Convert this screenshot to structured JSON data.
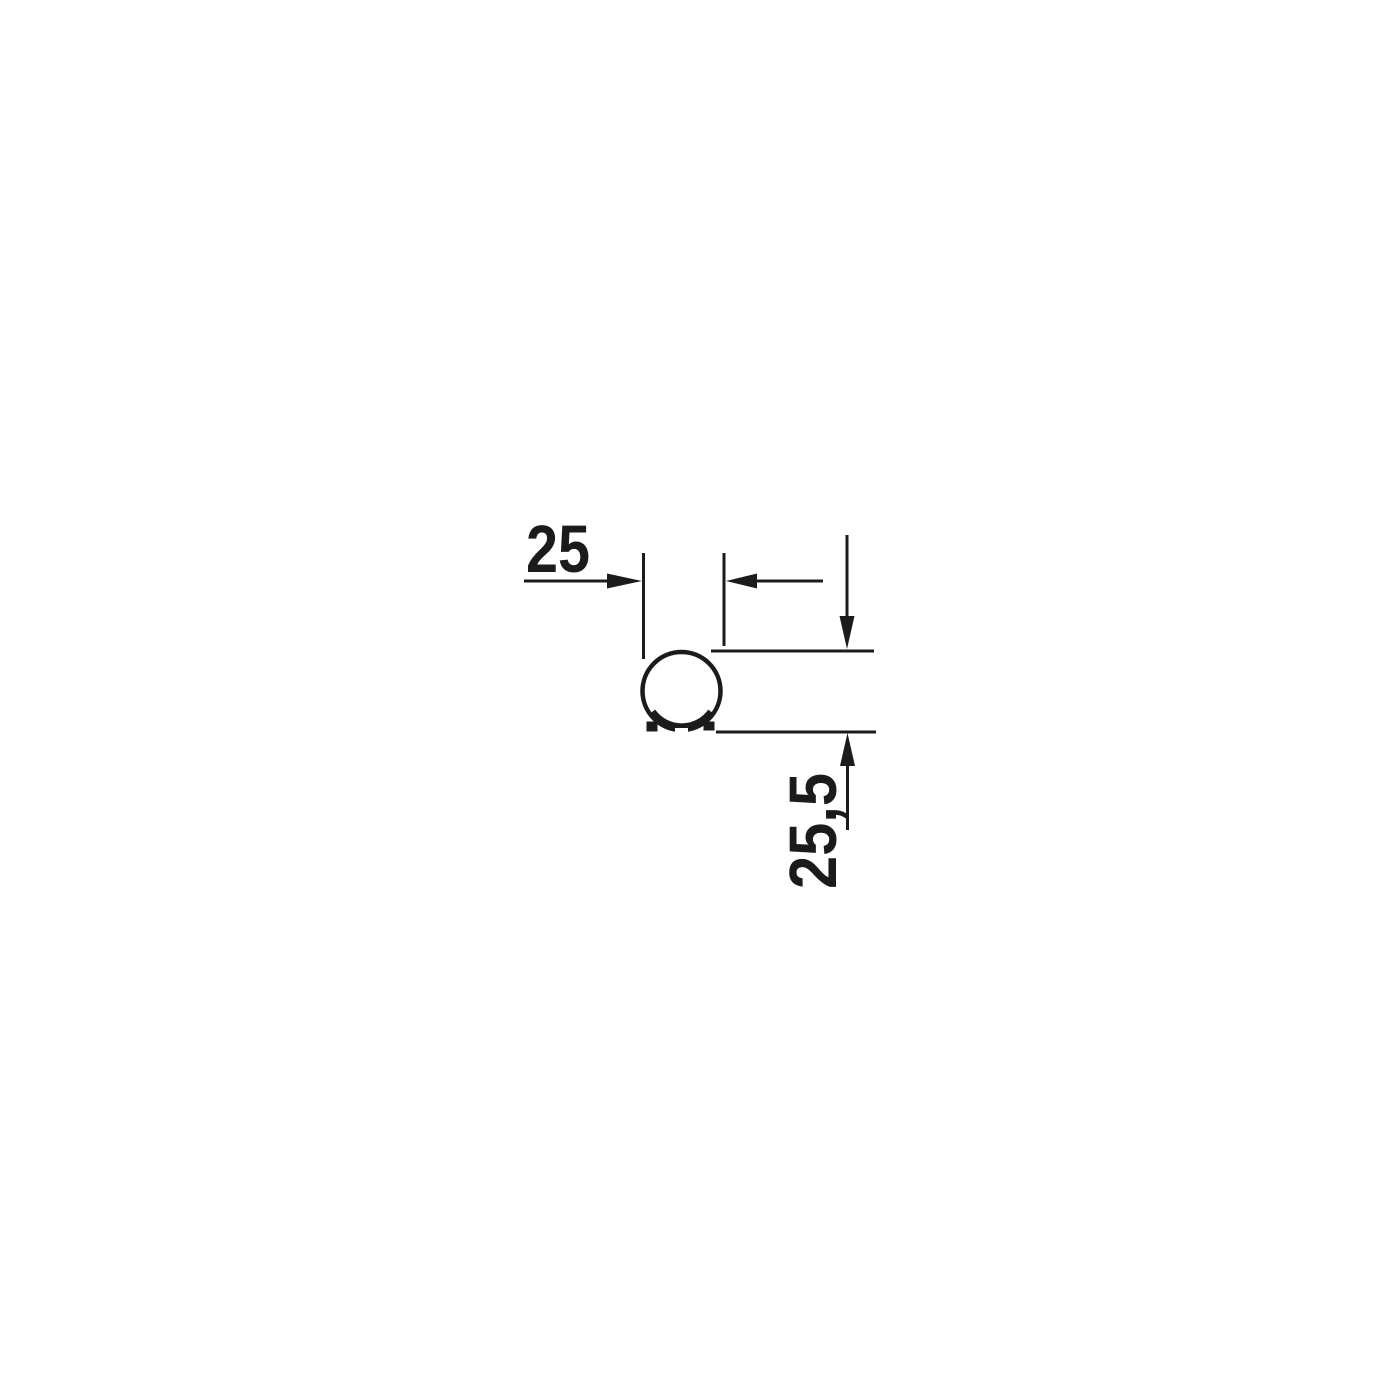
{
  "diagram": {
    "labels": {
      "width_dimension": "25",
      "height_dimension": "25,5"
    },
    "colors": {
      "line": "#1b1b1b",
      "background": "#ffffff"
    }
  }
}
